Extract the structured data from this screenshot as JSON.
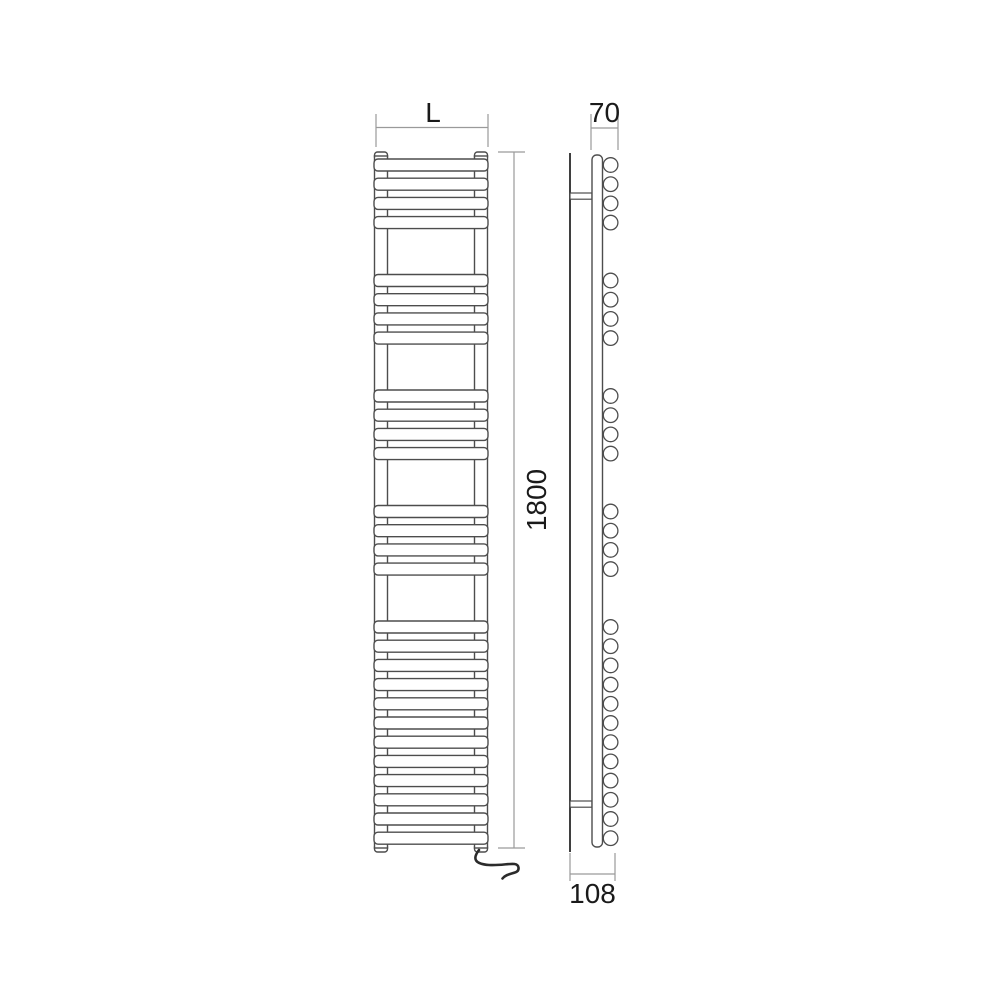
{
  "meta": {
    "type": "technical-dimension-drawing",
    "subject": "heated towel rail radiator, front and side elevation"
  },
  "labels": {
    "width": "L",
    "height": "1800",
    "depth_total": "108",
    "depth_rail": "70"
  },
  "structure": {
    "views": [
      "front",
      "side"
    ],
    "bar_groups": [
      4,
      4,
      4,
      4,
      12
    ],
    "total_bars": 28,
    "wall_brackets": 2,
    "has_power_cable": true
  },
  "colors": {
    "outline": "#4d4d4d",
    "wall_line": "#3f3f3f",
    "dimension": "#9a9a9a",
    "text": "#1a1a1a",
    "cable": "#2b2b2b",
    "fill": "#ffffff",
    "background": "#ffffff"
  }
}
